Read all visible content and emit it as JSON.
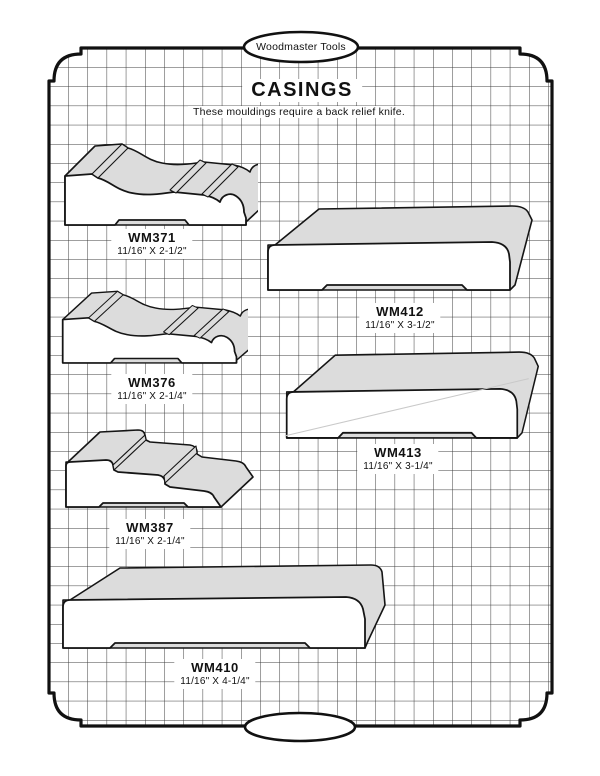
{
  "page": {
    "brand": "Woodmaster Tools",
    "title": "CASINGS",
    "note": "These mouldings require a back relief knife."
  },
  "products": [
    {
      "code": "WM371",
      "size": "11/16\" X 2-1/2\""
    },
    {
      "code": "WM412",
      "size": "11/16\" X 3-1/2\""
    },
    {
      "code": "WM376",
      "size": "11/16\" X 2-1/4\""
    },
    {
      "code": "WM413",
      "size": "11/16\" X 3-1/4\""
    },
    {
      "code": "WM387",
      "size": "11/16\" X 2-1/4\""
    },
    {
      "code": "WM410",
      "size": "11/16\" X 4-1/4\""
    }
  ],
  "icons": [
    {
      "name": "brand-oval-badge",
      "shape": "ellipse"
    },
    {
      "name": "footer-oval-badge",
      "shape": "ellipse"
    }
  ],
  "colors": {
    "outline": "#151515",
    "moulding_top_surface": "#dcdcdc",
    "moulding_face": "#ffffff",
    "grid_line": "#3d3d3d",
    "paper": "#ffffff"
  },
  "grid": {
    "cell_px": 19.2
  }
}
